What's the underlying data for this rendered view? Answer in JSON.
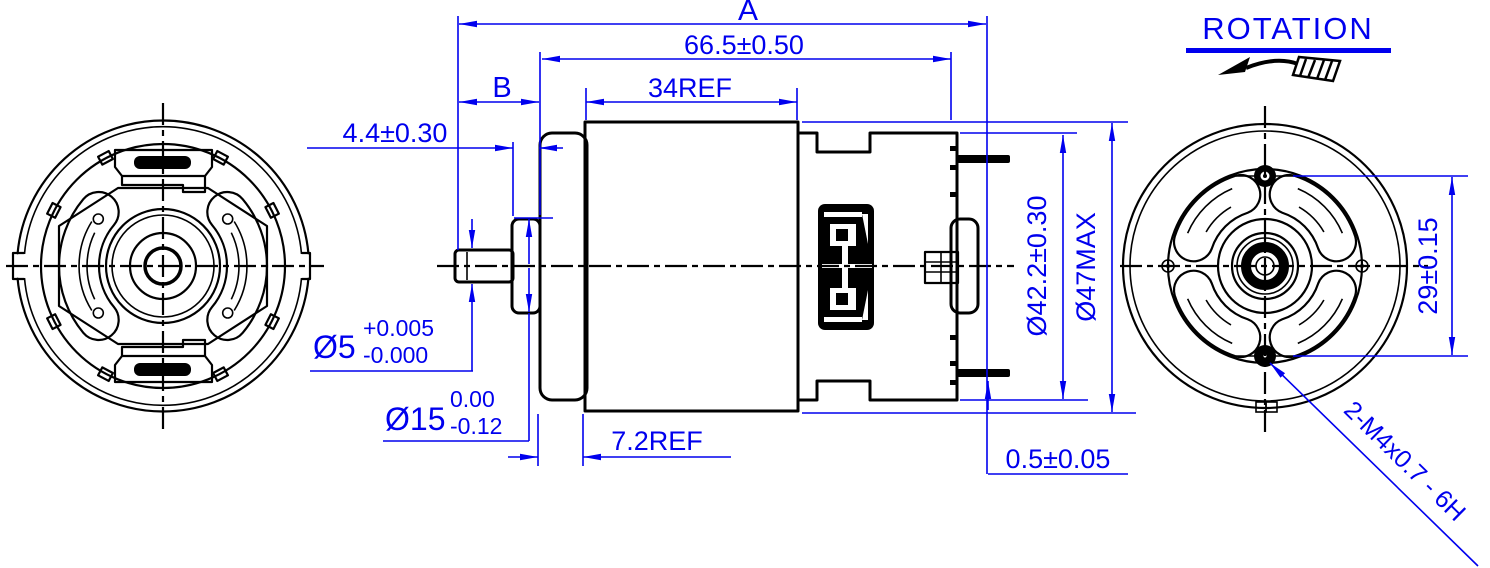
{
  "colors": {
    "dimension_blue": "#0000ee",
    "line_black": "#000000",
    "background": "#ffffff"
  },
  "labels": {
    "rotation": "ROTATION",
    "dim_A": "A",
    "dim_B": "B",
    "overall_length": "66.5±0.50",
    "stack_length": "34REF",
    "bushing_protrusion": "4.4±0.30",
    "shaft_dia": "Ø5",
    "shaft_tol_upper": "+0.005",
    "shaft_tol_lower": "-0.000",
    "bushing_dia": "Ø15",
    "bushing_tol_upper": "0.00",
    "bushing_tol_lower": "-0.12",
    "endbell_length": "7.2REF",
    "terminal_standoff": "0.5±0.05",
    "case_dia": "Ø42.2±0.30",
    "max_dia": "Ø47MAX",
    "hole_spacing": "29±0.15",
    "mounting_holes": "2-M4x0.7 - 6H"
  }
}
